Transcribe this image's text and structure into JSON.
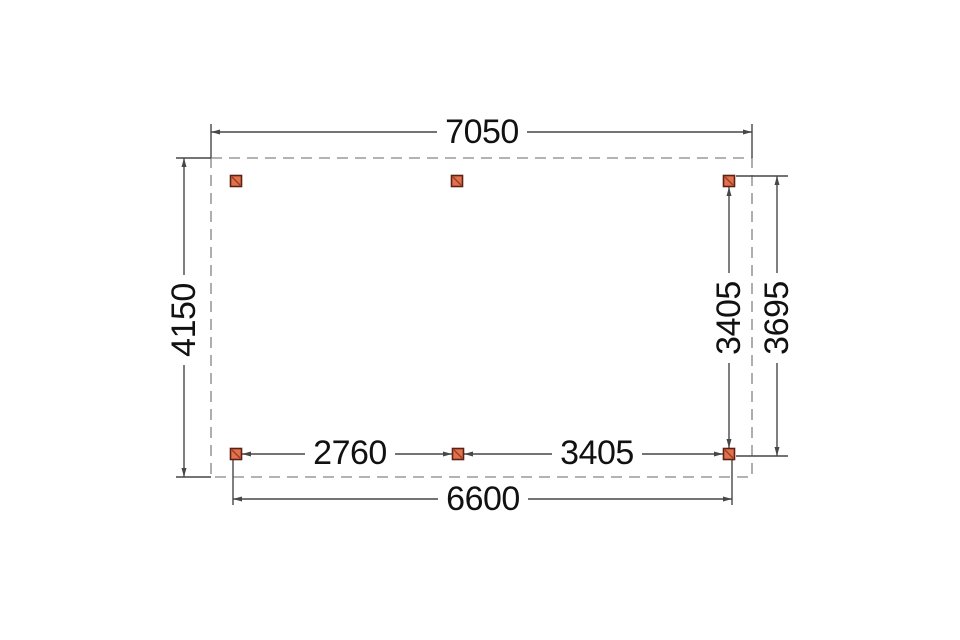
{
  "drawing": {
    "type": "top-view dimension plan (veranda/carport foundation)",
    "dimension_labels": {
      "overall_width": "7050",
      "overall_depth": "4150",
      "right_inner_span": "3405",
      "right_outer_span": "3695",
      "bottom_left_span": "2760",
      "bottom_right_span": "3405",
      "bottom_overall": "6600"
    },
    "posts": {
      "count": 6,
      "shape": "square with diagonal hatch",
      "layout": "3 along top edge, 3 along bottom edge"
    },
    "outline": {
      "style": "dashed rectangle"
    },
    "colors": {
      "post_fill": "#e0734e",
      "post_border": "#5e2012",
      "post_hatch": "#9c3a22",
      "dimension_line": "#474747",
      "dashed_outline": "#9a9a9a",
      "label_text": "#111111",
      "background": "#ffffff"
    }
  }
}
